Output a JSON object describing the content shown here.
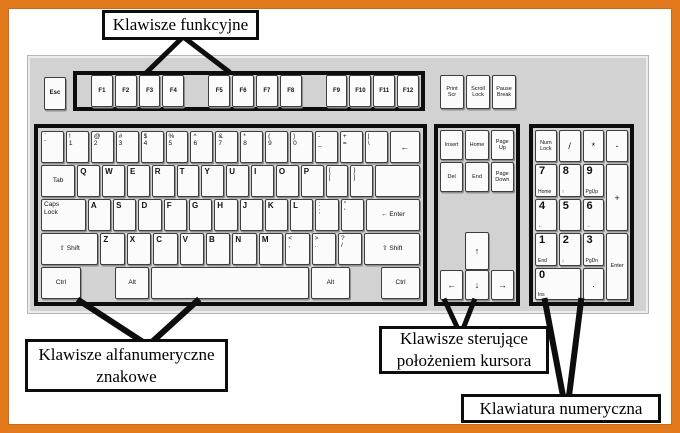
{
  "colors": {
    "frame_orange": "#e2791d",
    "keyboard_gray": "#d2d2d2",
    "block_border": "#0d0d0d",
    "key_white": "#fbfbfb"
  },
  "labels": {
    "function": "Klawisze funkcyjne",
    "alpha_line1": "Klawisze alfanumeryczne",
    "alpha_line2": "znakowe",
    "cursor_line1": "Klawisze sterujące",
    "cursor_line2": "położeniem kursora",
    "numeric": "Klawiatura numeryczna"
  },
  "keyboard": {
    "esc": {
      "l": [
        "Esc"
      ],
      "c": 1,
      "cls": "fk"
    },
    "function_keys": [
      [
        "F1",
        "F2",
        "F3",
        "F4"
      ],
      [
        "F5",
        "F6",
        "F7",
        "F8"
      ],
      [
        "F9",
        "F10",
        "F11",
        "F12"
      ]
    ],
    "system_keys": [
      {
        "l": [
          "Print",
          "Scr"
        ],
        "c": 1,
        "cls": "nv"
      },
      {
        "l": [
          "Scroll",
          "Lock"
        ],
        "c": 1,
        "cls": "nv"
      },
      {
        "l": [
          "Pause",
          "Break"
        ],
        "c": 1,
        "cls": "nv"
      }
    ],
    "main_rows": [
      [
        {
          "l": [
            "`",
            "`"
          ]
        },
        {
          "l": [
            "!",
            "1"
          ]
        },
        {
          "l": [
            "@",
            "2"
          ]
        },
        {
          "l": [
            "#",
            "3"
          ]
        },
        {
          "l": [
            "$",
            "4"
          ]
        },
        {
          "l": [
            "%",
            "5"
          ]
        },
        {
          "l": [
            "^",
            "6"
          ]
        },
        {
          "l": [
            "&",
            "7"
          ]
        },
        {
          "l": [
            "*",
            "8"
          ]
        },
        {
          "l": [
            "(",
            "9"
          ]
        },
        {
          "l": [
            ")",
            "0"
          ]
        },
        {
          "l": [
            "-",
            "_"
          ]
        },
        {
          "l": [
            "+",
            "="
          ]
        },
        {
          "l": [
            "|",
            "\\"
          ]
        },
        {
          "l": [
            "←"
          ],
          "c": 1,
          "cls": "arrow",
          "w": 1.55
        }
      ],
      [
        {
          "l": [
            "Tab"
          ],
          "c": 1,
          "cls": "mod",
          "w": 1.8
        },
        {
          "l": [
            "Q"
          ],
          "cls": "letter"
        },
        {
          "l": [
            "W"
          ],
          "cls": "letter"
        },
        {
          "l": [
            "E"
          ],
          "cls": "letter"
        },
        {
          "l": [
            "R"
          ],
          "cls": "letter"
        },
        {
          "l": [
            "T"
          ],
          "cls": "letter"
        },
        {
          "l": [
            "Y"
          ],
          "cls": "letter"
        },
        {
          "l": [
            "U"
          ],
          "cls": "letter"
        },
        {
          "l": [
            "I"
          ],
          "cls": "letter"
        },
        {
          "l": [
            "O"
          ],
          "cls": "letter"
        },
        {
          "l": [
            "P"
          ],
          "cls": "letter"
        },
        {
          "l": [
            "{",
            "["
          ]
        },
        {
          "l": [
            "}",
            "]"
          ]
        },
        {
          "l": [
            ""
          ],
          "w": 2.3
        }
      ],
      [
        {
          "l": [
            "Caps",
            "Lock"
          ],
          "cls": "mod",
          "w": 2.25
        },
        {
          "l": [
            "A"
          ],
          "cls": "letter"
        },
        {
          "l": [
            "S"
          ],
          "cls": "letter"
        },
        {
          "l": [
            "D"
          ],
          "cls": "letter"
        },
        {
          "l": [
            "F"
          ],
          "cls": "letter"
        },
        {
          "l": [
            "G"
          ],
          "cls": "letter"
        },
        {
          "l": [
            "H"
          ],
          "cls": "letter"
        },
        {
          "l": [
            "J"
          ],
          "cls": "letter"
        },
        {
          "l": [
            "K"
          ],
          "cls": "letter"
        },
        {
          "l": [
            "L"
          ],
          "cls": "letter"
        },
        {
          "l": [
            ":",
            ";"
          ]
        },
        {
          "l": [
            "\"",
            "'"
          ]
        },
        {
          "l": [
            "← Enter"
          ],
          "c": 1,
          "cls": "mod",
          "w": 2.9
        }
      ],
      [
        {
          "l": [
            "⇧ Shift"
          ],
          "c": 1,
          "cls": "mod",
          "w": 2.9
        },
        {
          "l": [
            "Z"
          ],
          "cls": "letter"
        },
        {
          "l": [
            "X"
          ],
          "cls": "letter"
        },
        {
          "l": [
            "C"
          ],
          "cls": "letter"
        },
        {
          "l": [
            "V"
          ],
          "cls": "letter"
        },
        {
          "l": [
            "B"
          ],
          "cls": "letter"
        },
        {
          "l": [
            "N"
          ],
          "cls": "letter"
        },
        {
          "l": [
            "M"
          ],
          "cls": "letter"
        },
        {
          "l": [
            "<",
            ","
          ]
        },
        {
          "l": [
            ">",
            "."
          ]
        },
        {
          "l": [
            "?",
            "/"
          ]
        },
        {
          "l": [
            "⇧ Shift"
          ],
          "c": 1,
          "cls": "mod",
          "w": 2.8
        }
      ],
      [
        {
          "l": [
            "Ctrl"
          ],
          "c": 1,
          "cls": "mod",
          "w": 1.7
        },
        {
          "gap": 1,
          "w": 1.25
        },
        {
          "l": [
            "Alt"
          ],
          "c": 1,
          "cls": "mod",
          "w": 1.4
        },
        {
          "l": [
            ""
          ],
          "w": 7.2
        },
        {
          "l": [
            "Alt"
          ],
          "c": 1,
          "cls": "mod",
          "w": 1.65
        },
        {
          "gap": 1,
          "w": 1.1
        },
        {
          "l": [
            "Ctrl"
          ],
          "c": 1,
          "cls": "mod",
          "w": 1.65
        }
      ]
    ],
    "nav": {
      "top": [
        {
          "l": [
            "Insert"
          ],
          "c": 1,
          "cls": "nv"
        },
        {
          "l": [
            "Home"
          ],
          "c": 1,
          "cls": "nv"
        },
        {
          "l": [
            "Page",
            "Up"
          ],
          "c": 1,
          "cls": "nv"
        },
        {
          "l": [
            "Del"
          ],
          "c": 1,
          "cls": "nv"
        },
        {
          "l": [
            "End"
          ],
          "c": 1,
          "cls": "nv"
        },
        {
          "l": [
            "Page",
            "Down"
          ],
          "c": 1,
          "cls": "nv"
        }
      ],
      "up": {
        "l": [
          "↑"
        ],
        "c": 1,
        "cls": "arrow"
      },
      "bottom": [
        {
          "l": [
            "←"
          ],
          "c": 1,
          "cls": "arrow"
        },
        {
          "l": [
            "↓"
          ],
          "c": 1,
          "cls": "arrow"
        },
        {
          "l": [
            "→"
          ],
          "c": 1,
          "cls": "arrow"
        }
      ]
    },
    "numpad": [
      {
        "l": [
          "Num",
          "Lock"
        ],
        "c": 1,
        "cls": "nv"
      },
      {
        "l": [
          "/"
        ],
        "c": 1,
        "cls": "op"
      },
      {
        "l": [
          "*"
        ],
        "c": 1,
        "cls": "op"
      },
      {
        "l": [
          "-"
        ],
        "c": 1,
        "cls": "op"
      },
      {
        "d": "7",
        "s": "Home"
      },
      {
        "d": "8",
        "s": "↑"
      },
      {
        "d": "9",
        "s": "PgUp"
      },
      {
        "l": [
          "+"
        ],
        "c": 1,
        "cls": "op",
        "rs": 2
      },
      {
        "d": "4",
        "s": "←"
      },
      {
        "d": "5",
        "s": ""
      },
      {
        "d": "6",
        "s": "→"
      },
      {
        "d": "1",
        "s": "End"
      },
      {
        "d": "2",
        "s": "↓"
      },
      {
        "d": "3",
        "s": "PgDn"
      },
      {
        "l": [
          "Enter"
        ],
        "c": 1,
        "cls": "nv",
        "rs": 2
      },
      {
        "d": "0",
        "s": "Ins",
        "cs": 2
      },
      {
        "l": [
          "."
        ],
        "c": 1,
        "cls": "op"
      }
    ]
  },
  "pointers": [
    {
      "x1": 148,
      "y1": 71,
      "x2": 181,
      "y2": 39,
      "w": 5
    },
    {
      "x1": 228,
      "y1": 71,
      "x2": 186,
      "y2": 39,
      "w": 5
    },
    {
      "x1": 80,
      "y1": 301,
      "x2": 143,
      "y2": 342,
      "w": 6
    },
    {
      "x1": 197,
      "y1": 301,
      "x2": 152,
      "y2": 342,
      "w": 6
    },
    {
      "x1": 445,
      "y1": 301,
      "x2": 458,
      "y2": 329,
      "w": 5
    },
    {
      "x1": 474,
      "y1": 301,
      "x2": 463,
      "y2": 329,
      "w": 5
    },
    {
      "x1": 545,
      "y1": 301,
      "x2": 563,
      "y2": 396,
      "w": 6
    },
    {
      "x1": 581,
      "y1": 301,
      "x2": 569,
      "y2": 396,
      "w": 6
    }
  ]
}
